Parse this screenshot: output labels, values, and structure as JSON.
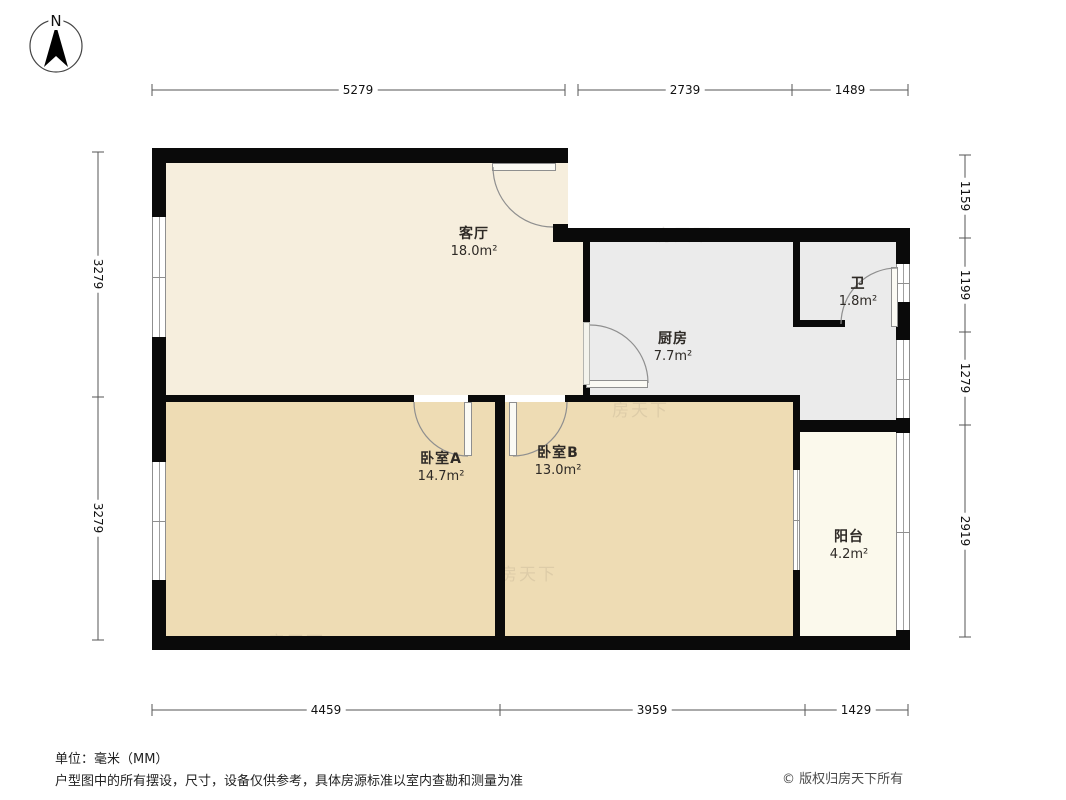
{
  "compass": {
    "label": "N"
  },
  "dims": {
    "top": [
      "5279",
      "2739",
      "1489"
    ],
    "bottom": [
      "4459",
      "3959",
      "1429"
    ],
    "left": [
      "3279",
      "3279"
    ],
    "right": [
      "1159",
      "1199",
      "1279",
      "2919"
    ]
  },
  "rooms": [
    {
      "id": "living",
      "name": "客厅",
      "area": "18.0m²"
    },
    {
      "id": "kitchen",
      "name": "厨房",
      "area": "7.7m²"
    },
    {
      "id": "bath",
      "name": "卫",
      "area": "1.8m²"
    },
    {
      "id": "bedroomA",
      "name": "卧室A",
      "area": "14.7m²"
    },
    {
      "id": "bedroomB",
      "name": "卧室B",
      "area": "13.0m²"
    },
    {
      "id": "balcony",
      "name": "阳台",
      "area": "4.2m²"
    }
  ],
  "footer": {
    "unit": "单位：毫米（MM）",
    "disclaimer": "户型图中的所有摆设，尺寸，设备仅供参考，具体房源标准以室内查勘和测量为准",
    "copyright": "© 版权归房天下所有"
  },
  "watermark": {
    "text": "房天下"
  },
  "colors": {
    "living": "#f6eedd",
    "kitchen": "#ebebeb",
    "bedroom": "#eedcb4",
    "balcony": "#fbf9ec",
    "wall": "#0a0a0a"
  }
}
